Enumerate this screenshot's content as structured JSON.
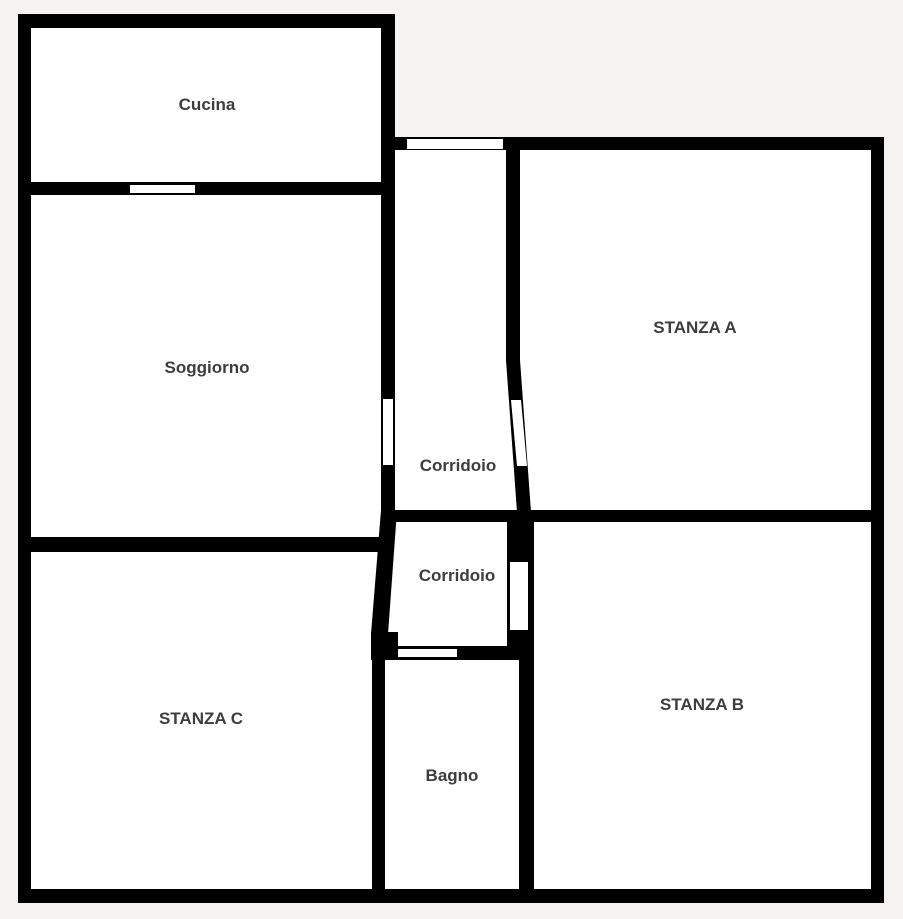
{
  "floorplan": {
    "colors": {
      "background": "#f4f3f1",
      "wall": "#000000",
      "room": "#ffffff",
      "label": "#3d3d3d"
    },
    "rooms": [
      {
        "name": "cucina",
        "label": "Cucina"
      },
      {
        "name": "soggiorno",
        "label": "Soggiorno"
      },
      {
        "name": "stanza-c",
        "label": "STANZA C"
      },
      {
        "name": "corridoio-upper",
        "label": "Corridoio"
      },
      {
        "name": "corridoio-lower",
        "label": "Corridoio"
      },
      {
        "name": "bagno",
        "label": "Bagno"
      },
      {
        "name": "stanza-a",
        "label": "STANZA A"
      },
      {
        "name": "stanza-b",
        "label": "STANZA B"
      }
    ],
    "openings": [
      {
        "name": "window-cucina-soggiorno",
        "type": "window"
      },
      {
        "name": "door-corridoio-top",
        "type": "door"
      },
      {
        "name": "door-soggiorno-corridoio",
        "type": "door"
      },
      {
        "name": "door-corridoio-stanza-a",
        "type": "door"
      },
      {
        "name": "door-corridoio-stanza-b",
        "type": "door"
      },
      {
        "name": "door-corridoio-bagno",
        "type": "door"
      }
    ]
  }
}
